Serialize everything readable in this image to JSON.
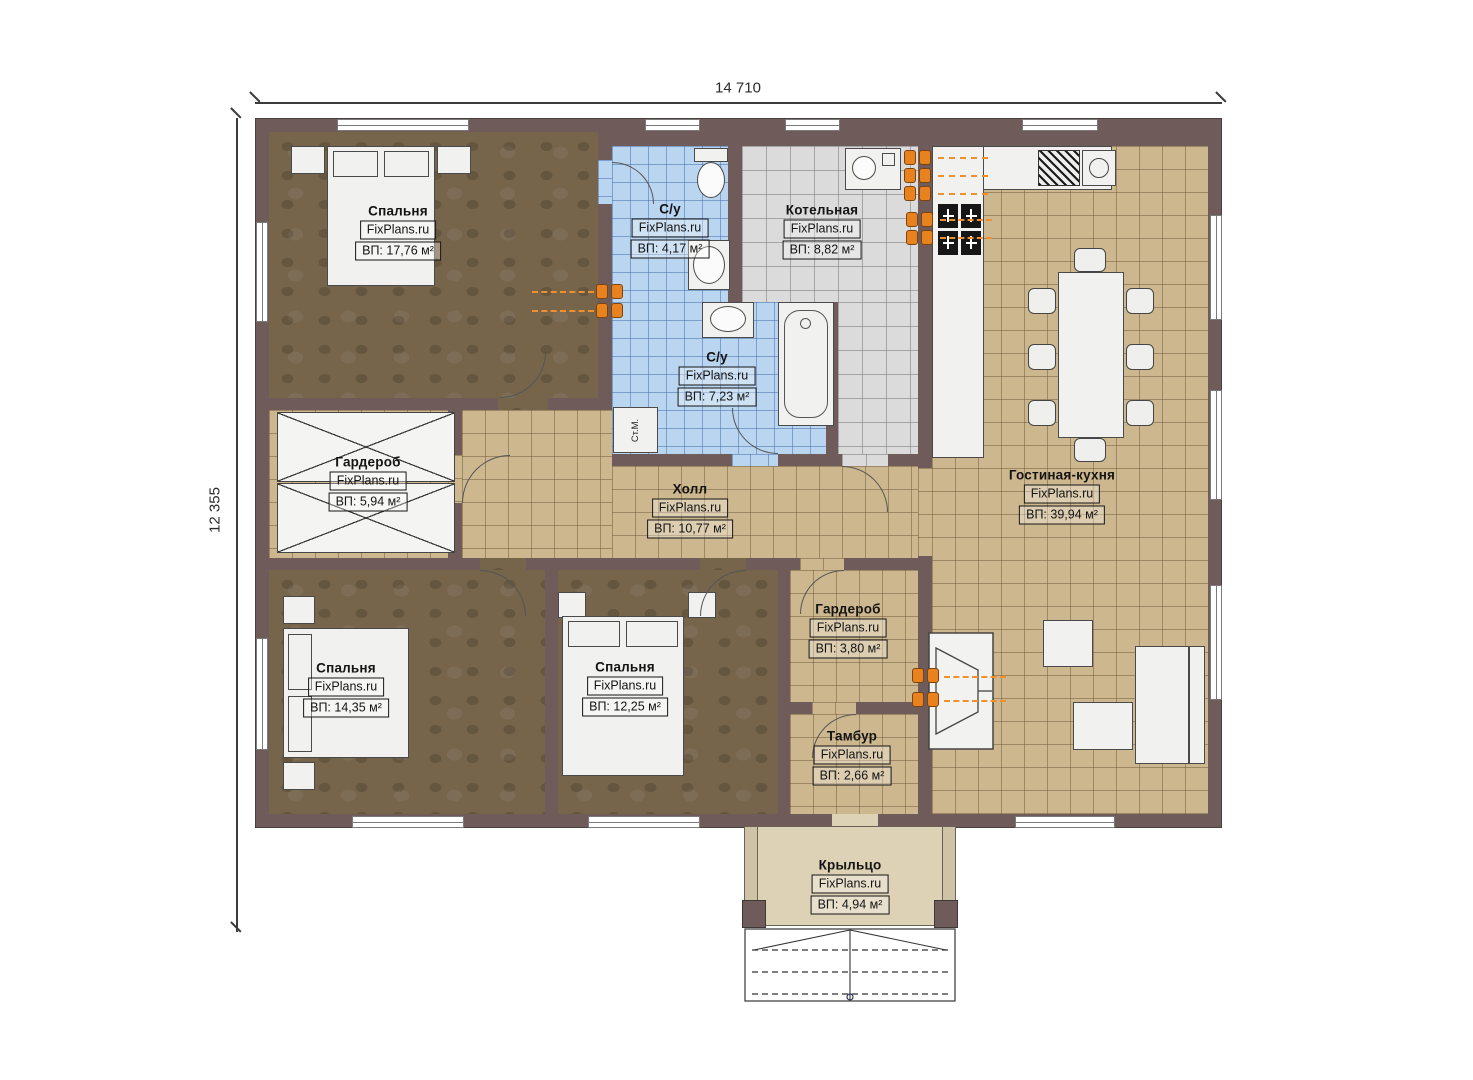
{
  "dimensions": {
    "width_label": "14 710",
    "height_label": "12 355"
  },
  "rooms": [
    {
      "id": "bedroom-1",
      "name": "Спальня",
      "brand": "FixPlans.ru",
      "area": "ВП: 17,76 м²"
    },
    {
      "id": "wc-top",
      "name": "С/у",
      "brand": "FixPlans.ru",
      "area": "ВП: 4,17 м²"
    },
    {
      "id": "boiler-room",
      "name": "Котельная",
      "brand": "FixPlans.ru",
      "area": "ВП: 8,82 м²"
    },
    {
      "id": "wc-main",
      "name": "С/у",
      "brand": "FixPlans.ru",
      "area": "ВП: 7,23 м²"
    },
    {
      "id": "wardrobe-1",
      "name": "Гардероб",
      "brand": "FixPlans.ru",
      "area": "ВП: 5,94 м²"
    },
    {
      "id": "hall",
      "name": "Холл",
      "brand": "FixPlans.ru",
      "area": "ВП: 10,77 м²"
    },
    {
      "id": "living-kitchen",
      "name": "Гостиная-кухня",
      "brand": "FixPlans.ru",
      "area": "ВП: 39,94 м²"
    },
    {
      "id": "bedroom-2",
      "name": "Спальня",
      "brand": "FixPlans.ru",
      "area": "ВП: 14,35 м²"
    },
    {
      "id": "bedroom-3",
      "name": "Спальня",
      "brand": "FixPlans.ru",
      "area": "ВП: 12,25 м²"
    },
    {
      "id": "wardrobe-2",
      "name": "Гардероб",
      "brand": "FixPlans.ru",
      "area": "ВП: 3,80 м²"
    },
    {
      "id": "vestibule",
      "name": "Тамбур",
      "brand": "FixPlans.ru",
      "area": "ВП: 2,66 м²"
    },
    {
      "id": "porch",
      "name": "Крыльцо",
      "brand": "FixPlans.ru",
      "area": "ВП: 4,94 м²"
    }
  ],
  "annotations": {
    "washing_machine": "Ст.М."
  },
  "colors": {
    "wall": "#6f5c5a",
    "floor_wood": "#76644b",
    "tile_tan": "#cdb78e",
    "tile_blue": "#b9d5ef",
    "tile_gray": "#dbdbdb",
    "porch": "#ddd1b6",
    "accent_orange": "#e8821f"
  }
}
